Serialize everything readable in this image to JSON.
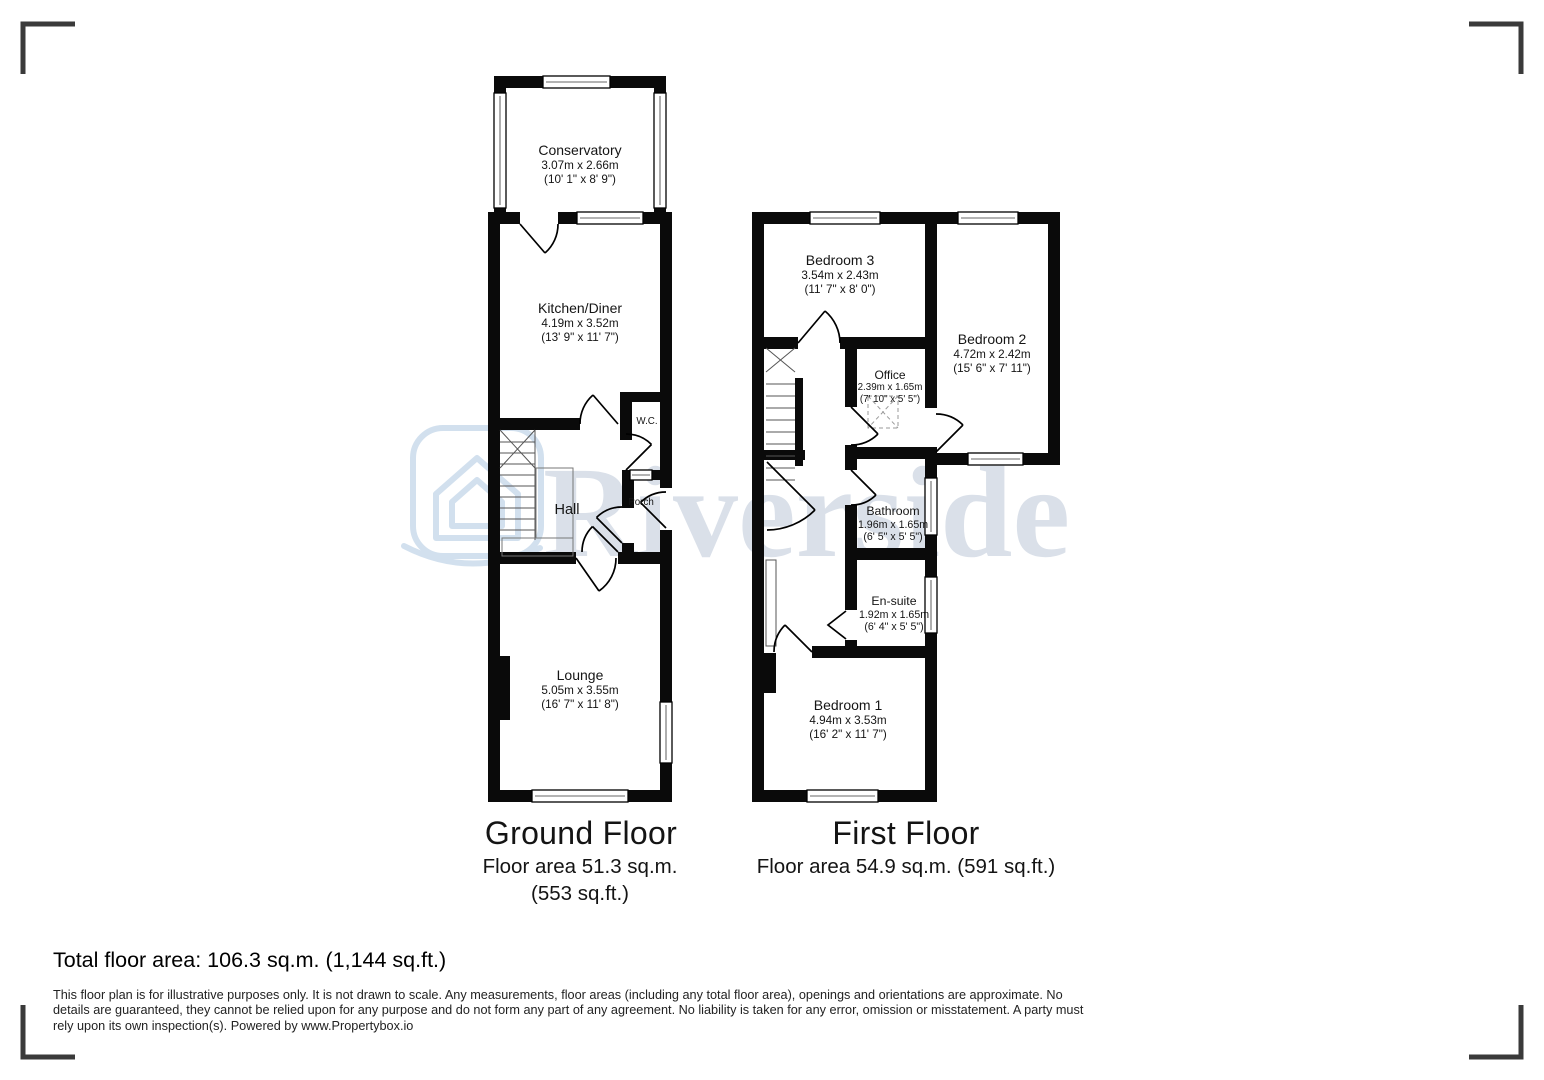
{
  "watermark": {
    "text": "Riverside",
    "text_color": "#dae0e9",
    "logo_color": "#c7d9ea"
  },
  "ground_floor": {
    "title": "Ground Floor",
    "area_metric": "Floor area 51.3 sq.m.",
    "area_imperial": "(553 sq.ft.)",
    "rooms": {
      "conservatory": {
        "name": "Conservatory",
        "metric": "3.07m x 2.66m",
        "imperial": "(10' 1\" x 8' 9\")"
      },
      "kitchen_diner": {
        "name": "Kitchen/Diner",
        "metric": "4.19m x 3.52m",
        "imperial": "(13' 9\" x 11' 7\")"
      },
      "wc": {
        "name": "W.C."
      },
      "hall": {
        "name": "Hall"
      },
      "porch": {
        "name": "Porch"
      },
      "lounge": {
        "name": "Lounge",
        "metric": "5.05m x 3.55m",
        "imperial": "(16' 7\" x 11' 8\")"
      }
    }
  },
  "first_floor": {
    "title": "First Floor",
    "area": "Floor area 54.9 sq.m. (591 sq.ft.)",
    "rooms": {
      "bedroom3": {
        "name": "Bedroom 3",
        "metric": "3.54m x 2.43m",
        "imperial": "(11' 7\" x 8' 0\")"
      },
      "bedroom2": {
        "name": "Bedroom 2",
        "metric": "4.72m x 2.42m",
        "imperial": "(15' 6\" x 7' 11\")"
      },
      "office": {
        "name": "Office",
        "metric": "2.39m x 1.65m",
        "imperial": "(7' 10\" x 5' 5\")"
      },
      "bathroom": {
        "name": "Bathroom",
        "metric": "1.96m x 1.65m",
        "imperial": "(6' 5\" x 5' 5\")"
      },
      "ensuite": {
        "name": "En-suite",
        "metric": "1.92m x 1.65m",
        "imperial": "(6' 4\" x 5' 5\")"
      },
      "bedroom1": {
        "name": "Bedroom 1",
        "metric": "4.94m x 3.53m",
        "imperial": "(16' 2\" x 11' 7\")"
      }
    }
  },
  "summary": {
    "total": "Total floor area: 106.3 sq.m. (1,144 sq.ft.)"
  },
  "disclaimer": "This floor plan is for illustrative purposes only. It is not drawn to scale. Any measurements, floor areas (including any total floor area), openings and orientations are approximate. No details are guaranteed, they cannot be relied upon for any purpose and do not form any part of any agreement. No liability is taken for any error, omission or misstatement. A party must rely upon its own inspection(s). Powered by www.Propertybox.io"
}
